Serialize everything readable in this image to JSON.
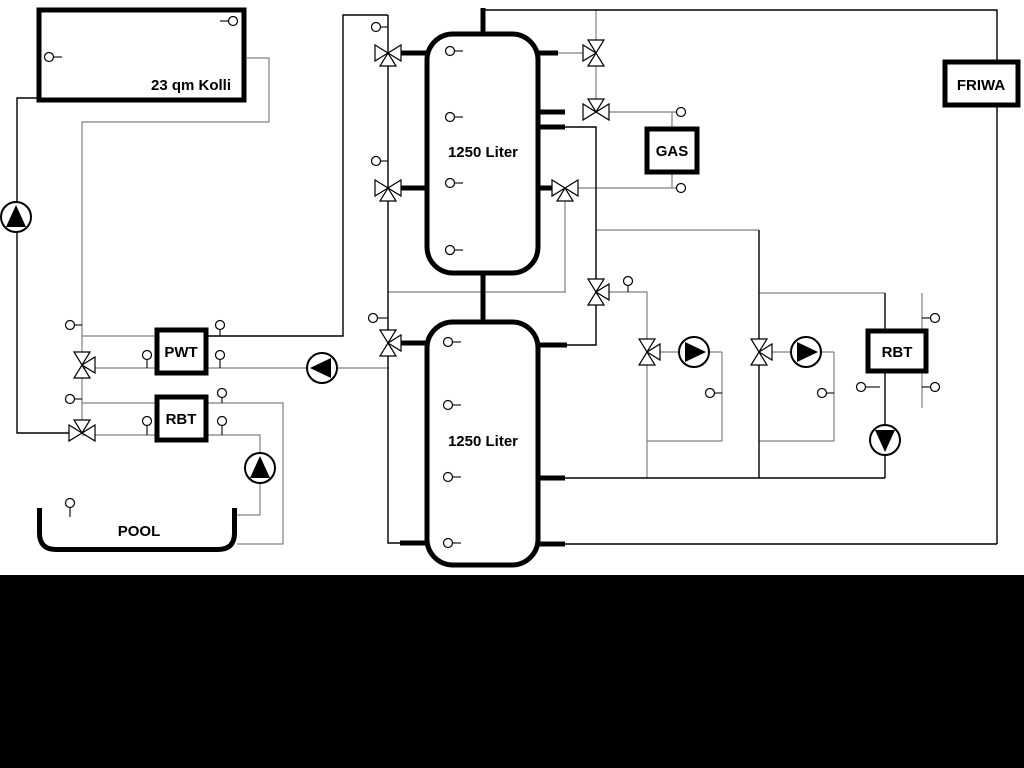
{
  "labels": {
    "collector": "23 qm Kolli",
    "tank1": "1250 Liter",
    "tank2": "1250 Liter",
    "pwt": "PWT",
    "rbt_left": "RBT",
    "gas": "GAS",
    "friwa": "FRIWA",
    "rbt_right": "RBT",
    "pool": "POOL"
  },
  "colors": {
    "background": "#ffffff",
    "pipe_gray": "#808080",
    "pipe_black": "#000000",
    "footer_bar": "#000000"
  },
  "equipment_summary": {
    "buffer_tanks": [
      "1250 Liter",
      "1250 Liter"
    ],
    "pump_count": 6,
    "three_way_valve_count": 11,
    "temperature_sensor_count": 30
  }
}
